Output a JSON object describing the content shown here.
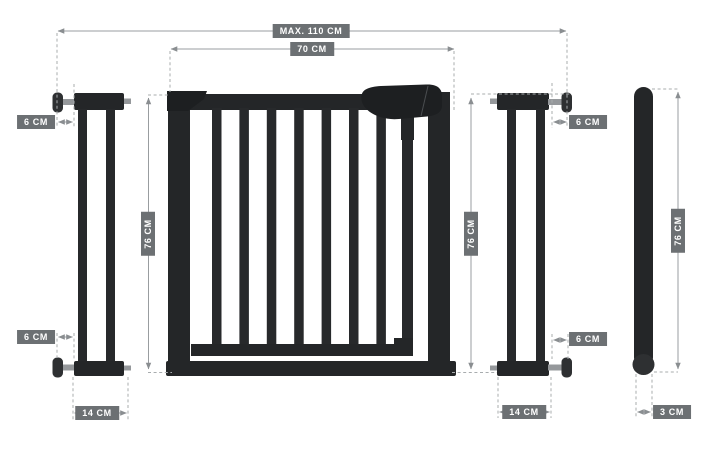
{
  "dimensions": {
    "max_total_width": "MAX. 110 CM",
    "gate_panel_width": "70 CM",
    "gate_height": "76 CM",
    "left_extension": {
      "top_depth": "6 CM",
      "bottom_depth": "6 CM",
      "base_width": "14 CM"
    },
    "right_extension": {
      "top_depth": "6 CM",
      "bottom_depth": "6 CM",
      "base_width": "14 CM",
      "height": "76 CM"
    },
    "side_profile": {
      "height": "76 CM",
      "bar_depth": "3 CM"
    }
  },
  "colors": {
    "background": "#ffffff",
    "badge_bg": "#6c7073",
    "badge_text": "#ffffff",
    "dimension_line": "#999da0",
    "dashed_line": "#a8acae",
    "product_dark": "#232527",
    "hardware_gray": "#95989b"
  }
}
